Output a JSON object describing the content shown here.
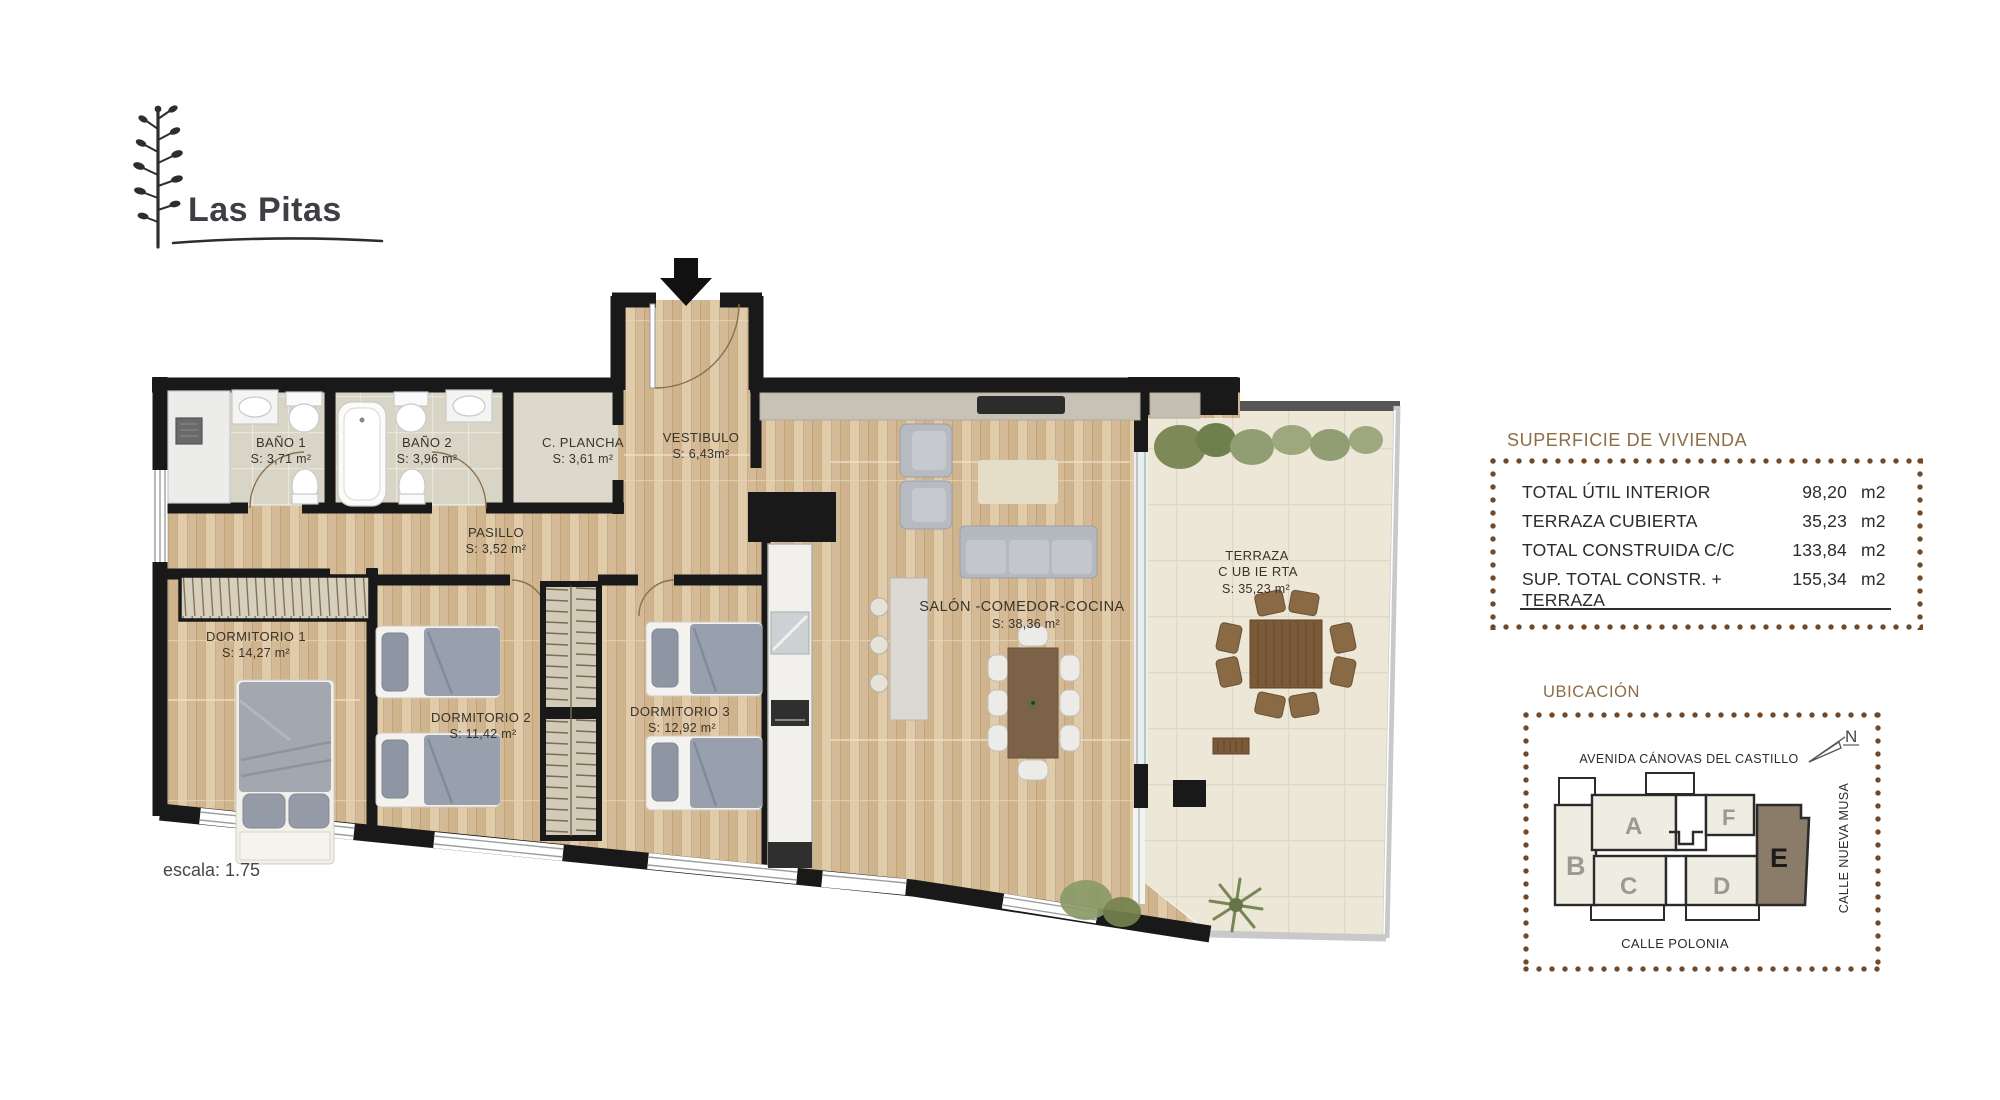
{
  "brand": {
    "name": "Las Pitas"
  },
  "scale_note": "escala: 1.75",
  "plan": {
    "rooms": [
      {
        "name": "BAÑO 1",
        "area": "S: 3,71 m²"
      },
      {
        "name": "BAÑO 2",
        "area": "S: 3,96 m²"
      },
      {
        "name": "C. PLANCHA",
        "area": "S: 3,61 m²"
      },
      {
        "name": "VESTIBULO",
        "area": "S: 6,43m²"
      },
      {
        "name": "PASILLO",
        "area": "S: 3,52 m²"
      },
      {
        "name": "DORMITORIO 1",
        "area": "S: 14,27 m²"
      },
      {
        "name": "DORMITORIO 2",
        "area": "S: 11,42 m²"
      },
      {
        "name": "DORMITORIO 3",
        "area": "S: 12,92 m²"
      },
      {
        "name": "SALÓN -COMEDOR-COCINA",
        "area": "S: 38,36 m²"
      },
      {
        "name": "TERRAZA",
        "name2": "C UB IE RTA",
        "area": "S: 35,23 m²"
      }
    ]
  },
  "surface_panel": {
    "title": "SUPERFICIE DE VIVIENDA",
    "rows": [
      {
        "label": "TOTAL ÚTIL INTERIOR",
        "value": "98,20",
        "unit": "m2"
      },
      {
        "label": "TERRAZA CUBIERTA",
        "value": "35,23",
        "unit": "m2"
      },
      {
        "label": "TOTAL CONSTRUIDA C/C",
        "value": "133,84",
        "unit": "m2"
      },
      {
        "label": "SUP. TOTAL CONSTR. + TERRAZA",
        "value": "155,34",
        "unit": "m2"
      }
    ]
  },
  "location_panel": {
    "title": "UBICACIÓN",
    "north_label": "N",
    "streets": {
      "top": "AVENIDA CÁNOVAS DEL CASTILLO",
      "right": "CALLE NUEVA MUSA",
      "bottom": "CALLE POLONIA"
    },
    "units": [
      {
        "label": "B"
      },
      {
        "label": "A"
      },
      {
        "label": "F"
      },
      {
        "label": "C"
      },
      {
        "label": "D"
      },
      {
        "label": "E",
        "highlighted": true
      }
    ]
  },
  "colors": {
    "accent_brown": "#8b6d46",
    "dot_brown": "#6f4a28",
    "wall": "#191919",
    "wood_floor": "#d8bf9d",
    "terrace_floor": "#ece7d7",
    "highlighted_unit": "#8b7b69"
  }
}
